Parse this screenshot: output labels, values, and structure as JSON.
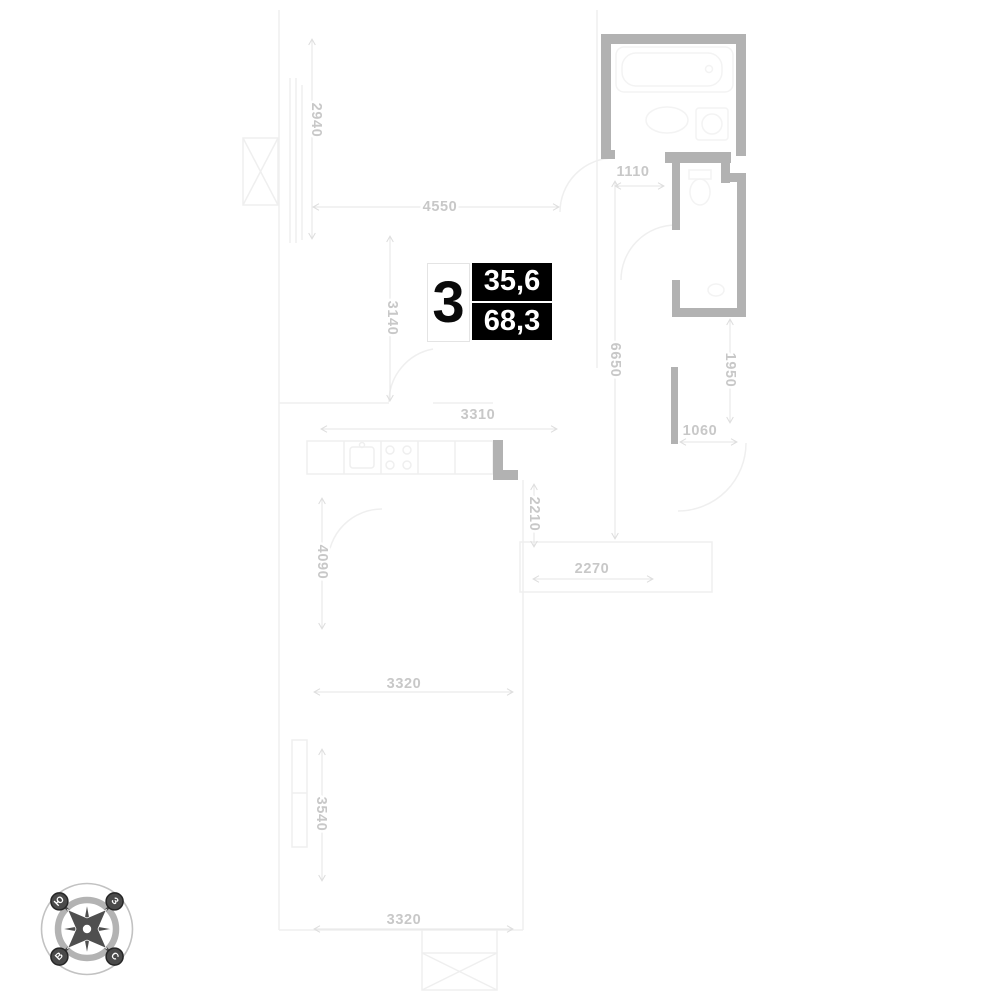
{
  "unit": {
    "number": "3",
    "living_area": "35,6",
    "total_area": "68,3"
  },
  "dimensions": [
    {
      "label": "2940",
      "orientation": "vertical"
    },
    {
      "label": "4550",
      "orientation": "horizontal"
    },
    {
      "label": "1110",
      "orientation": "horizontal"
    },
    {
      "label": "3140",
      "orientation": "vertical"
    },
    {
      "label": "6650",
      "orientation": "vertical"
    },
    {
      "label": "1950",
      "orientation": "vertical"
    },
    {
      "label": "3310",
      "orientation": "horizontal"
    },
    {
      "label": "1060",
      "orientation": "horizontal"
    },
    {
      "label": "2210",
      "orientation": "vertical"
    },
    {
      "label": "2270",
      "orientation": "horizontal"
    },
    {
      "label": "4090",
      "orientation": "vertical"
    },
    {
      "label": "3320",
      "orientation": "horizontal"
    },
    {
      "label": "3540",
      "orientation": "vertical"
    },
    {
      "label": "3320",
      "orientation": "horizontal"
    }
  ],
  "compass": {
    "south": "Ю",
    "west": "З",
    "east": "В",
    "north": "С"
  },
  "colors": {
    "wall": "#b2b2b2",
    "dim_text": "#c8c8c8",
    "faint_line": "#efefef",
    "dim_line": "#e4e4e4",
    "area_box_bg": "#000000",
    "area_box_text": "#ffffff",
    "compass_dark": "#4f4f4f"
  }
}
